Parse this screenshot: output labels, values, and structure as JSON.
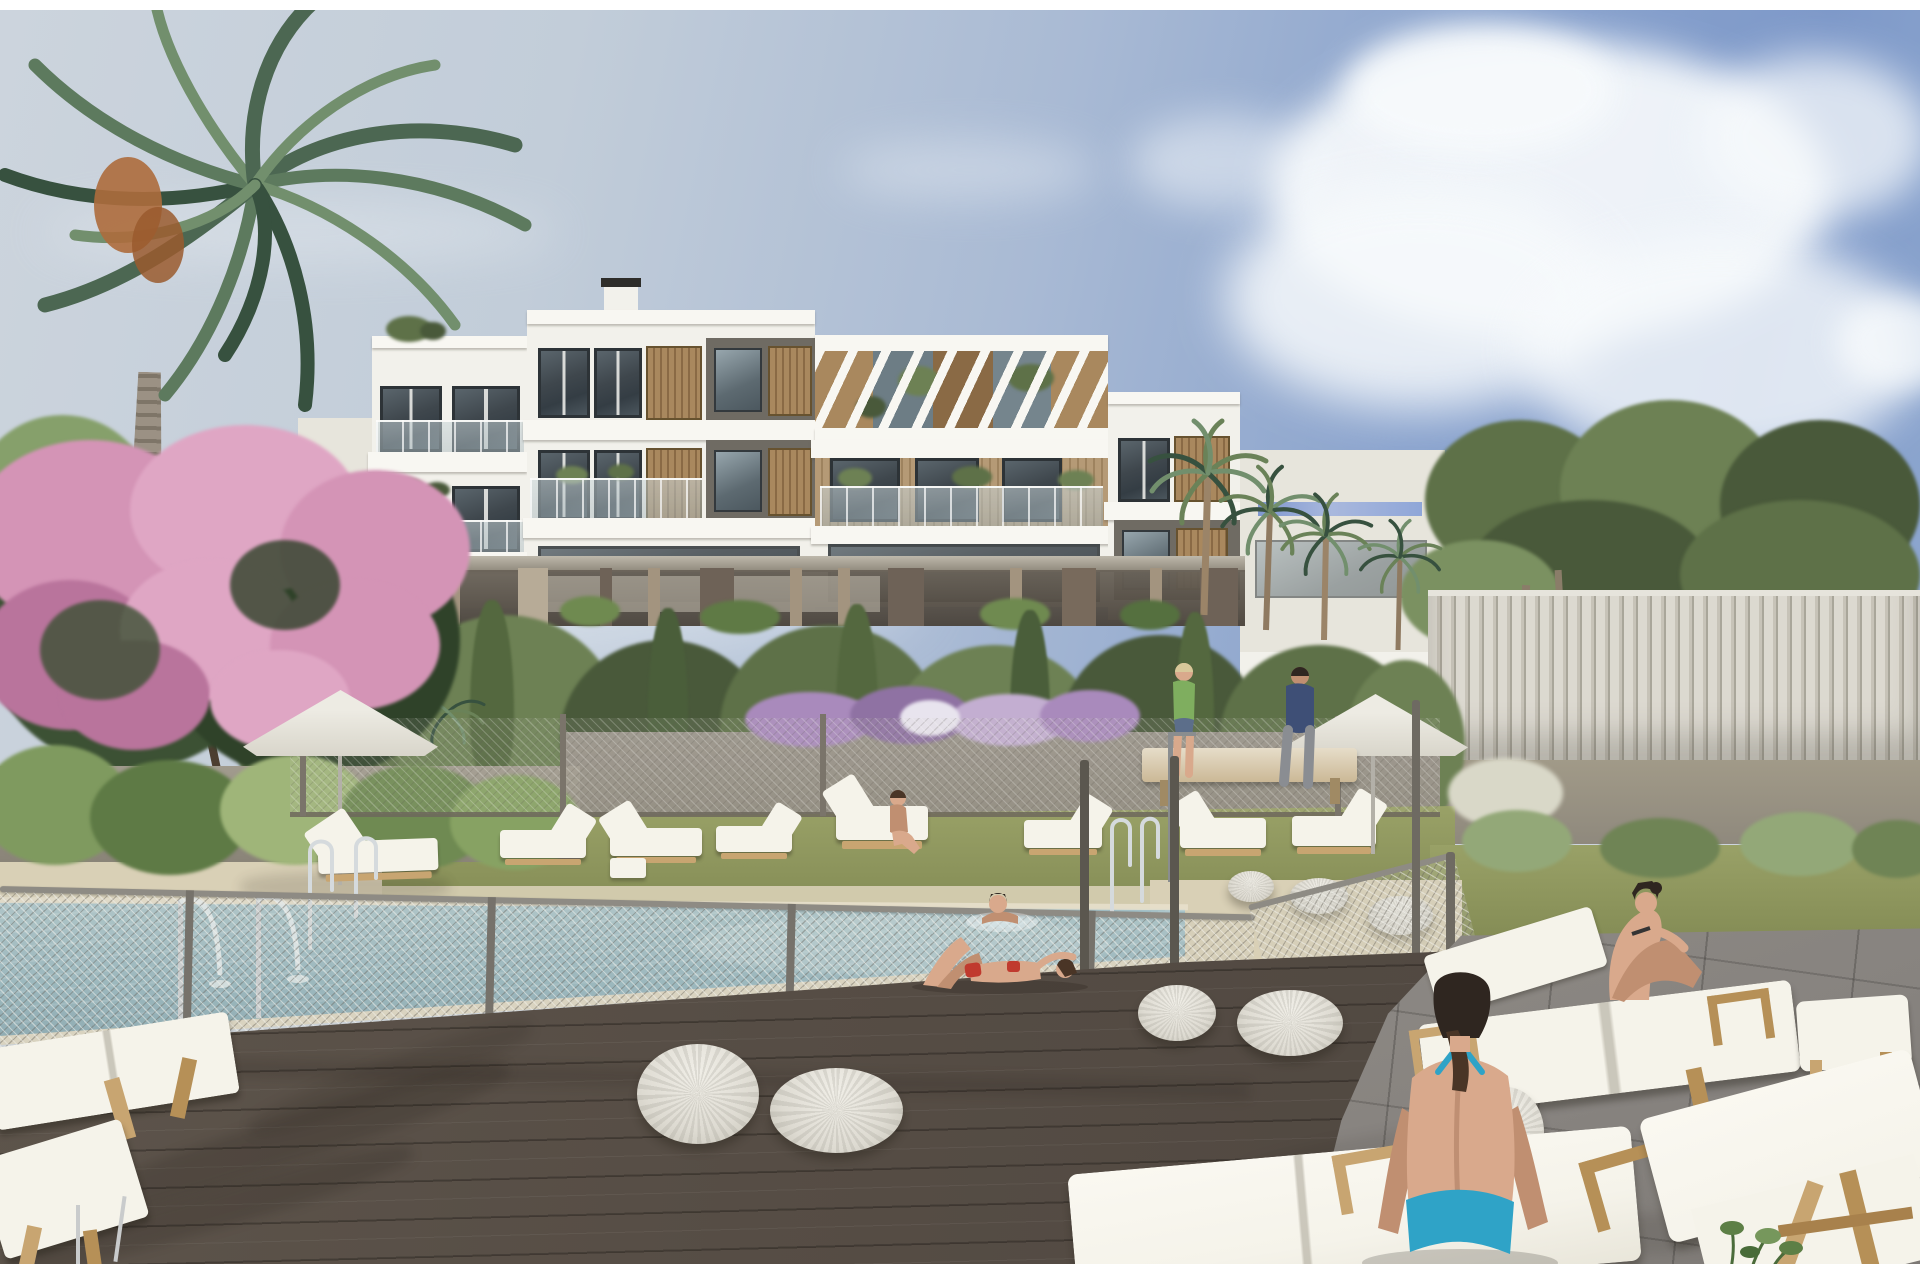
{
  "meta": {
    "kind": "architectural-rendering",
    "description": "Photorealistic render of a modern white three-storey apartment building with wooden slat accents and a rooftop pergola, seen from its communal pool area: a fenced swimming pool with fountains and ladders, sun loungers, white parasols, woven poufs, a dark wood and stone deck, lush mediterranean vegetation including palms and a pink bougainvillea, under a blue sky with cumulus clouds",
    "width_px": 1920,
    "height_px": 1280
  },
  "palette": {
    "sky1": "#ccd4dd",
    "sky2": "#a9bad4",
    "sky3": "#7e99c9",
    "cloud": "#f7fafc",
    "bwhite": "#f2f1eb",
    "bwhite2": "#e7e5dc",
    "fascia": "#f8f7f2",
    "glassd": "#3f474d",
    "glassm": "#5d6a71",
    "glassl": "#97a6ad",
    "wood": "#a9885e",
    "wood2": "#8a6a45",
    "panelg": "#6f6b63",
    "pillart": "#a3947f",
    "pillard": "#6e6257",
    "fol1": "#5e7148",
    "fol2": "#6d8154",
    "fol3": "#49593a",
    "fol4": "#7b9161",
    "conifer": "#3e5138",
    "palm1": "#4c6752",
    "palm2": "#5d7a5e",
    "palm3": "#728f6d",
    "palm4": "#37513f",
    "trunk": "#9b9184",
    "trunkd": "#7e7568",
    "pink1": "#d494b6",
    "pink2": "#dfa6c4",
    "pink3": "#b9749c",
    "purple1": "#a98abc",
    "purple2": "#8f72a3",
    "grass": "#99a167",
    "grassd": "#848c55",
    "sand": "#d9d0b6",
    "wallg": "#8f897d",
    "slat1": "#dcd9d0",
    "slat2": "#a9a69a",
    "meshbg": "rgba(205,203,195,0.22)",
    "post": "#76726b",
    "postd": "#5b574f",
    "rail": "rgba(200,212,216,0.55)",
    "water1": "#a7c3c9",
    "water2": "#7fa3ae",
    "coping": "#e7e0cc",
    "coping2": "#ddd5bf",
    "plank": "#564d45",
    "plankd": "#3e3731",
    "paver": "#87837f",
    "paverd": "#6a6662",
    "cushion": "#f5f3ea",
    "lwood": "#c8a571",
    "pouf1": "#f0eee7",
    "pouf2": "#c9c6bb",
    "umb": "#edebe3",
    "umb2": "#d8d5ca",
    "pole": "#b3b0a8",
    "chrome": "#d5dadd",
    "skin": "#d9a98c",
    "skin2": "#c08f71",
    "hair": "#2f2620",
    "hair2": "#4a3526",
    "red": "#c03a2e",
    "teal": "#2fa3c7",
    "greentop": "#7fae5f",
    "shirt": "#3e4f76",
    "pants": "#8a8d92",
    "benchwood": "#cbb896",
    "whiteband": "#ffffff",
    "fruit": "#ad6b3c",
    "shadow": "rgba(25,20,15,0.18)"
  },
  "scene": {
    "counts": {
      "parasols": 2,
      "woven_poufs": 7,
      "sun_loungers": 14,
      "people": 7,
      "fountain_jets": 2,
      "pool_ladders": 3
    },
    "objects": {
      "root": {
        "label": "poolside apartment building rendering"
      },
      "sky": {
        "label": "blue sky",
        "details": "pale haze left, deeper blue right"
      },
      "clouds": {
        "label": "cumulus clouds top right"
      },
      "building": {
        "label": "white apartment building",
        "details": "3 storeys on pilotis, glass balconies, wood slat panels, dark grey wall sections"
      },
      "pergola": {
        "label": "rooftop pergola with white rafters and wood slats"
      },
      "palm_left": {
        "label": "large palm tree top left",
        "details": "with orange date clusters"
      },
      "bougainvillea": {
        "label": "pink bougainvillea tree left"
      },
      "conifers": {
        "label": "dark conifer trees left"
      },
      "trees_right": {
        "label": "dense green trees right background"
      },
      "palms_right": {
        "label": "palm cluster beside building right"
      },
      "hedge": {
        "label": "garden hedge screen behind pool fence"
      },
      "flowers_purple": {
        "label": "purple flower bed on garden wall"
      },
      "planter_left": {
        "label": "left planter wall with tropical plants"
      },
      "slat_fence": {
        "label": "white vertical-slat privacy fence right"
      },
      "mesh_fence": {
        "label": "chain-link pool safety fence with gate"
      },
      "pool": {
        "label": "swimming pool",
        "details": "rectangular, seen through mesh fence"
      },
      "fountains": {
        "label": "two arched water jets at pool edge"
      },
      "ladders": {
        "label": "chrome pool ladders"
      },
      "parasol_left": {
        "label": "white parasol left"
      },
      "parasol_right": {
        "label": "white parasol right"
      },
      "grass": {
        "label": "lawn lounge strip behind pool"
      },
      "loungers_back": {
        "label": "row of white sun loungers on lawn"
      },
      "bench": {
        "label": "wooden lounger bench with two people right"
      },
      "deck_wood": {
        "label": "dark wood plank deck foreground"
      },
      "deck_stone": {
        "label": "grey stone paver terrace right"
      },
      "poufs": {
        "label": "white woven poufs"
      },
      "loungers_front": {
        "label": "foreground teak loungers with white cushions"
      },
      "ottoman": {
        "label": "white ottoman side table"
      },
      "shower": {
        "label": "outdoor pool shower"
      },
      "person_lying": {
        "label": "woman in red bikini sunbathing by pool"
      },
      "person_swimming": {
        "label": "person swimming in pool"
      },
      "person_seated_small": {
        "label": "person seated on lounger by hedge"
      },
      "person_bench_green": {
        "label": "woman in green top on bench"
      },
      "person_bench_blue": {
        "label": "man in dark blue shirt on bench"
      },
      "person_kneehug": {
        "label": "woman seated hugging knees on double lounger"
      },
      "person_foreground": {
        "label": "woman in turquoise bikini seated on lounger, back to viewer"
      },
      "frame_strips": {
        "label": "white frame strips at top and bottom edges"
      }
    }
  }
}
